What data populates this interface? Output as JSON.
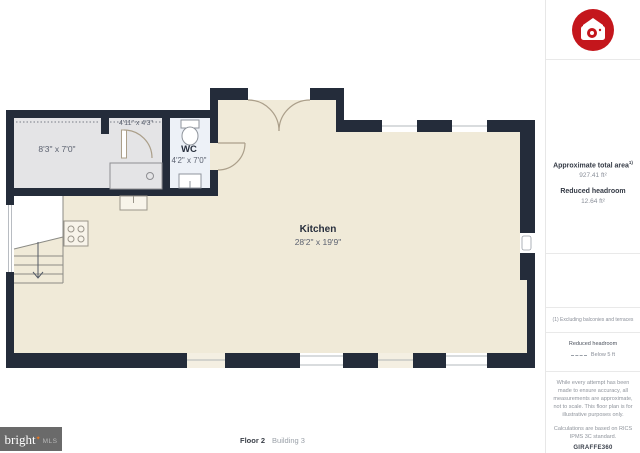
{
  "plan": {
    "kitchen": {
      "name": "Kitchen",
      "dims": "28'2\" x 19'9\""
    },
    "wc": {
      "name": "WC",
      "dims": "4'2\" x 7'0\""
    },
    "left_room": {
      "dims": "8'3\" x 7'0\""
    },
    "small_room": {
      "dims": "4'11\" x 4'3\""
    }
  },
  "sidebar": {
    "area_title": "Approximate total area",
    "area_sup": "1)",
    "area_value": "927.41 ft²",
    "headroom_title": "Reduced headroom",
    "headroom_value": "12.64 ft²",
    "footnote": "(1) Excluding balconies and terraces",
    "legend_title": "Reduced headroom",
    "legend_item": "Below 5 ft",
    "disclaimer1": "While every attempt has been made to ensure accuracy, all measurements are approximate, not to scale. This floor plan is for illustrative purposes only.",
    "disclaimer2": "Calculations are based on RICS IPMS 3C standard.",
    "brand": "GIRAFFE360"
  },
  "footer": {
    "logo_text": "bright",
    "logo_star": "✦",
    "logo_sub": "MLS",
    "floor_label": "Floor 2",
    "building_label": "Building 3"
  },
  "colors": {
    "wall": "#242c3a",
    "floor": "#f0ead8",
    "reduced_headroom_floor": "#e4e4e6",
    "wc_floor": "#edf1f7",
    "logo_red": "#c4161c",
    "logo_orange": "#e87722"
  }
}
